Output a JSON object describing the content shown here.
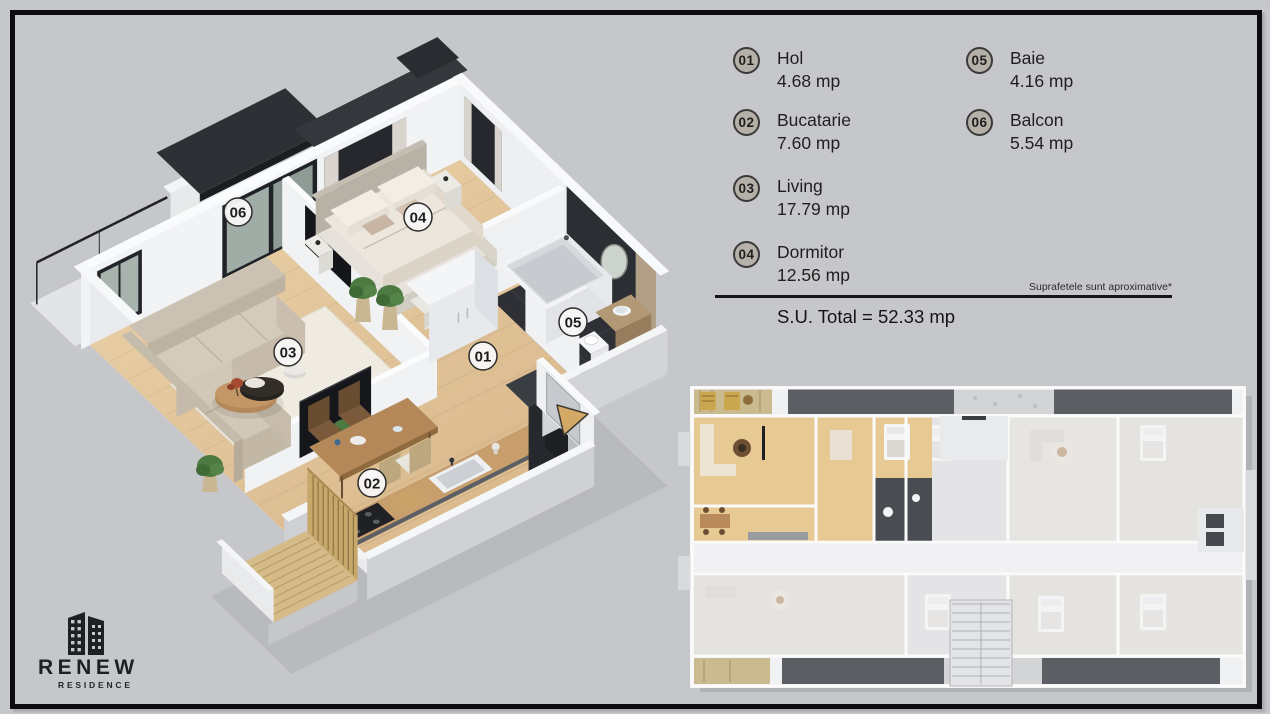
{
  "colors": {
    "background": "#c6c7ca",
    "frame": "#0c0c0e",
    "arrow_accent": "#d4a965",
    "legend_badge_fill": "#b6b1a8",
    "plan_badge_fill": "#f8f7f5"
  },
  "legend": {
    "items": [
      {
        "num": "01",
        "name": "Hol",
        "area": "4.68 mp"
      },
      {
        "num": "02",
        "name": "Bucatarie",
        "area": "7.60 mp"
      },
      {
        "num": "03",
        "name": "Living",
        "area": "17.79 mp"
      },
      {
        "num": "04",
        "name": "Dormitor",
        "area": "12.56 mp"
      },
      {
        "num": "05",
        "name": "Baie",
        "area": "4.16 mp"
      },
      {
        "num": "06",
        "name": "Balcon",
        "area": "5.54 mp"
      }
    ],
    "disclaimer": "Suprafetele sunt aproximative*",
    "total": "S.U. Total = 52.33 mp"
  },
  "plan_badges": [
    {
      "num": "01",
      "x": 483,
      "y": 356
    },
    {
      "num": "02",
      "x": 372,
      "y": 483
    },
    {
      "num": "03",
      "x": 288,
      "y": 352
    },
    {
      "num": "04",
      "x": 418,
      "y": 217
    },
    {
      "num": "05",
      "x": 573,
      "y": 322
    },
    {
      "num": "06",
      "x": 238,
      "y": 212
    }
  ],
  "logo": {
    "name": "RENEW",
    "subtitle": "RESIDENCE"
  }
}
